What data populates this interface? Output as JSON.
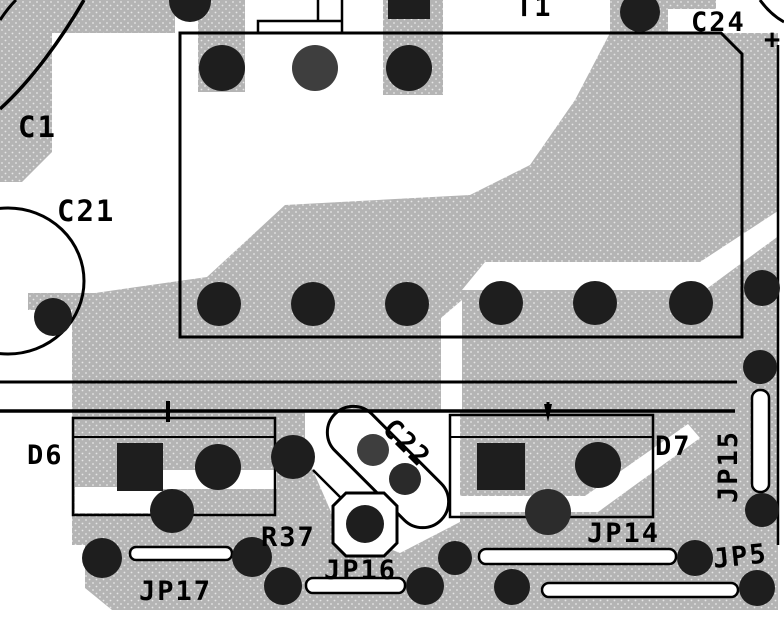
{
  "diagram": {
    "type": "pcb-layout-detail",
    "description": "Black-and-white PCB silkscreen/copper-pour detail view"
  },
  "labels": {
    "c1": {
      "text": "C1"
    },
    "c21": {
      "text": "C21"
    },
    "c22": {
      "text": "C22"
    },
    "c24": {
      "text": "C24"
    },
    "c24_polarity": {
      "text": "+"
    },
    "t1": {
      "text": "T1"
    },
    "d6": {
      "text": "D6"
    },
    "d7": {
      "text": "D7"
    },
    "r37": {
      "text": "R37"
    },
    "jp5": {
      "text": "JP5"
    },
    "jp14": {
      "text": "JP14"
    },
    "jp15": {
      "text": "JP15"
    },
    "jp16": {
      "text": "JP16"
    },
    "jp17": {
      "text": "JP17"
    }
  },
  "colors": {
    "copper_pour": "#b4b4b4",
    "pour_dot": "#e6e6e6",
    "silkscreen": "#000000",
    "pad_dark": "#1e1e1e",
    "pad_light": "#3e3e3e",
    "background": "#ffffff"
  }
}
